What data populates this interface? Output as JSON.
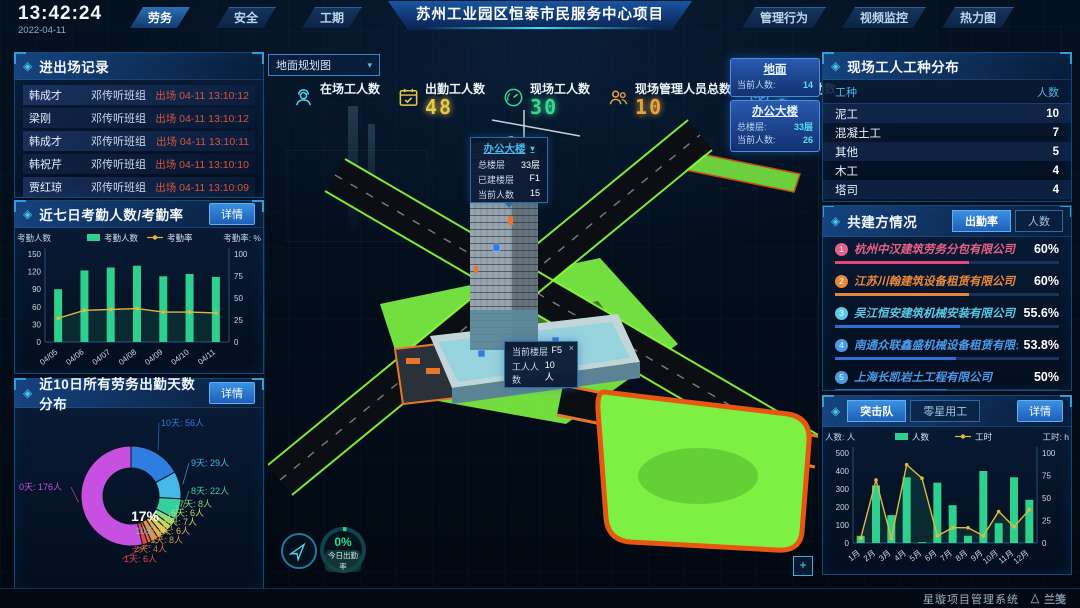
{
  "icons": {
    "panel_diamond": "◈",
    "caret_down": "▾",
    "close": "×",
    "expand": "+"
  },
  "topbar": {
    "time": "13:42:24",
    "date": "2022-04-11",
    "title": "苏州工业园区恒泰市民服务中心项目",
    "left_tabs": [
      {
        "label": "劳务",
        "active": true
      },
      {
        "label": "安全",
        "active": false
      },
      {
        "label": "工期",
        "active": false
      }
    ],
    "right_tabs": [
      {
        "label": "管理行为",
        "active": false
      },
      {
        "label": "视频监控",
        "active": false
      },
      {
        "label": "热力图",
        "active": false
      }
    ]
  },
  "left": {
    "records": {
      "title": "进出场记录",
      "more_label": "更多>>",
      "rows": [
        {
          "name": "韩成才",
          "group": "邓传听班组",
          "event": "出场 04-11 13:10:12"
        },
        {
          "name": "梁刚",
          "group": "邓传听班组",
          "event": "出场 04-11 13:10:12"
        },
        {
          "name": "韩成才",
          "group": "邓传听班组",
          "event": "出场 04-11 13:10:11"
        },
        {
          "name": "韩祝芹",
          "group": "邓传听班组",
          "event": "出场 04-11 13:10:10"
        },
        {
          "name": "贾红琼",
          "group": "邓传听班组",
          "event": "出场 04-11 13:10:09"
        }
      ]
    },
    "attendance": {
      "title": "近七日考勤人数/考勤率",
      "detail_label": "详情",
      "chart": {
        "type": "bar+line",
        "legend": [
          "考勤人数",
          "考勤率"
        ],
        "left_axis_title": "考勤人数",
        "right_axis_title": "考勤率: %",
        "categories": [
          "04/05",
          "04/06",
          "04/07",
          "04/08",
          "04/09",
          "04/10",
          "04/11"
        ],
        "bars": [
          90,
          122,
          127,
          130,
          112,
          116,
          111
        ],
        "line": [
          27,
          36,
          37,
          38,
          34,
          34,
          33
        ],
        "left_ticks": [
          0,
          30,
          60,
          90,
          120,
          150
        ],
        "right_ticks": [
          0,
          25,
          50,
          75,
          100
        ],
        "bar_color": "#2ed08d",
        "line_color": "#e0b83a"
      }
    },
    "distribution": {
      "title": "近10日所有劳务出勤天数分布",
      "detail_label": "详情",
      "center_value": "17%",
      "center_label": "10天",
      "chart": {
        "type": "donut",
        "unit": "人",
        "slices": [
          {
            "label": "10天",
            "count": 56,
            "color": "#2e7de0"
          },
          {
            "label": "9天",
            "count": 29,
            "color": "#45b8e8"
          },
          {
            "label": "8天",
            "count": 22,
            "color": "#35d0a0"
          },
          {
            "label": "7天",
            "count": 8,
            "color": "#8adc78"
          },
          {
            "label": "6天",
            "count": 6,
            "color": "#bcdc5e"
          },
          {
            "label": "5天",
            "count": 7,
            "color": "#dccf58"
          },
          {
            "label": "4天",
            "count": 6,
            "color": "#e0b050"
          },
          {
            "label": "3天",
            "count": 8,
            "color": "#e09048"
          },
          {
            "label": "2天",
            "count": 4,
            "color": "#e06a48"
          },
          {
            "label": "1天",
            "count": 6,
            "color": "#e04848"
          },
          {
            "label": "0天",
            "count": 176,
            "color": "#c850e0"
          }
        ]
      }
    }
  },
  "center": {
    "view_selector": "地面规划图",
    "stats": [
      {
        "label": "在场工人数",
        "value": "",
        "color": "#4ad8e8",
        "icon": "worker-icon"
      },
      {
        "label": "出勤工人数",
        "value": "48",
        "color": "#e8c84a",
        "icon": "calendar-check-icon"
      },
      {
        "label": "现场工人数",
        "value": "30",
        "color": "#35d98f",
        "icon": "gauge-icon"
      },
      {
        "label": "现场管理人员总数",
        "value": "10",
        "color": "#e8a23d",
        "icon": "managers-icon"
      },
      {
        "label": "异常出勤数",
        "value": "0",
        "color": "#4ab0e8",
        "icon": "pulse-icon"
      }
    ],
    "building_popup": {
      "title": "办公大楼",
      "rows": [
        {
          "label": "总楼层",
          "value": "33层"
        },
        {
          "label": "已建楼层",
          "value": "F1"
        },
        {
          "label": "当前人数",
          "value": "15"
        }
      ]
    },
    "floor_popup": {
      "rows": [
        {
          "label": "当前楼层",
          "value": "F5"
        },
        {
          "label": "工人人数",
          "value": "10人"
        }
      ]
    },
    "info_boxes": [
      {
        "title": "地面",
        "rows": [
          {
            "label": "当前人数:",
            "value": "14"
          }
        ]
      },
      {
        "title": "办公大楼",
        "rows": [
          {
            "label": "总楼层:",
            "value": "33层"
          },
          {
            "label": "当前人数:",
            "value": "26"
          }
        ]
      }
    ],
    "gauge": {
      "value": "0%",
      "label": "今日出勤率"
    }
  },
  "right": {
    "worker_types": {
      "title": "现场工人工种分布",
      "columns": [
        "工种",
        "人数"
      ],
      "rows": [
        {
          "type": "泥工",
          "count": "10"
        },
        {
          "type": "混凝土工",
          "count": "7"
        },
        {
          "type": "其他",
          "count": "5"
        },
        {
          "type": "木工",
          "count": "4"
        },
        {
          "type": "塔司",
          "count": "4"
        }
      ]
    },
    "partners": {
      "title": "共建方情况",
      "tabs": [
        {
          "label": "出勤率",
          "active": true
        },
        {
          "label": "人数",
          "active": false
        }
      ],
      "rows": [
        {
          "rank": "1",
          "name": "杭州中汉建筑劳务分包有限公司",
          "value": "60%",
          "pct": 60,
          "color": "#e8608a",
          "bar_color": "#e8457a"
        },
        {
          "rank": "2",
          "name": "江苏川翰建筑设备租赁有限公司",
          "value": "60%",
          "pct": 60,
          "color": "#e8883a",
          "bar_color": "#e8833a"
        },
        {
          "rank": "3",
          "name": "吴江恒安建筑机械安装有限公司",
          "value": "55.6%",
          "pct": 55.6,
          "color": "#5ac8e8",
          "bar_color": "#2f6fd8"
        },
        {
          "rank": "4",
          "name": "南通众联鑫盛机械设备租赁有限公司",
          "value": "53.8%",
          "pct": 53.8,
          "color": "#4a9ae8",
          "bar_color": "#2f6fd8"
        },
        {
          "rank": "5",
          "name": "上海长凯岩土工程有限公司",
          "value": "50%",
          "pct": 50,
          "color": "#4a9ae8",
          "bar_color": "#2f6fd8"
        },
        {
          "rank": "6",
          "name": "江苏洁绍建筑安装工程有限公司",
          "value": "35.4%",
          "pct": 35.4,
          "color": "#8a6ae8",
          "bar_color": "#2f6fd8"
        }
      ]
    },
    "teams": {
      "tabs": [
        {
          "label": "突击队",
          "active": true
        },
        {
          "label": "零星用工",
          "active": false
        }
      ],
      "detail_label": "详情",
      "chart": {
        "type": "bar+line",
        "legend": [
          "人数",
          "工时"
        ],
        "left_axis_title": "人数: 人",
        "right_axis_title": "工时: h",
        "categories": [
          "1月",
          "2月",
          "3月",
          "4月",
          "5月",
          "6月",
          "7月",
          "8月",
          "9月",
          "10月",
          "11月",
          "12月"
        ],
        "bars": [
          40,
          320,
          155,
          365,
          5,
          335,
          210,
          40,
          400,
          110,
          365,
          240
        ],
        "line": [
          5,
          70,
          5,
          87,
          72,
          8,
          17,
          17,
          8,
          35,
          18,
          37
        ],
        "left_ticks": [
          0,
          100,
          200,
          300,
          400,
          500
        ],
        "right_ticks": [
          0,
          25,
          50,
          75,
          100
        ],
        "bar_color": "#2ed08d",
        "line_color": "#e0b83a"
      }
    }
  },
  "footer": {
    "system_name": "星璇项目管理系统",
    "logo_text": "兰笺"
  }
}
